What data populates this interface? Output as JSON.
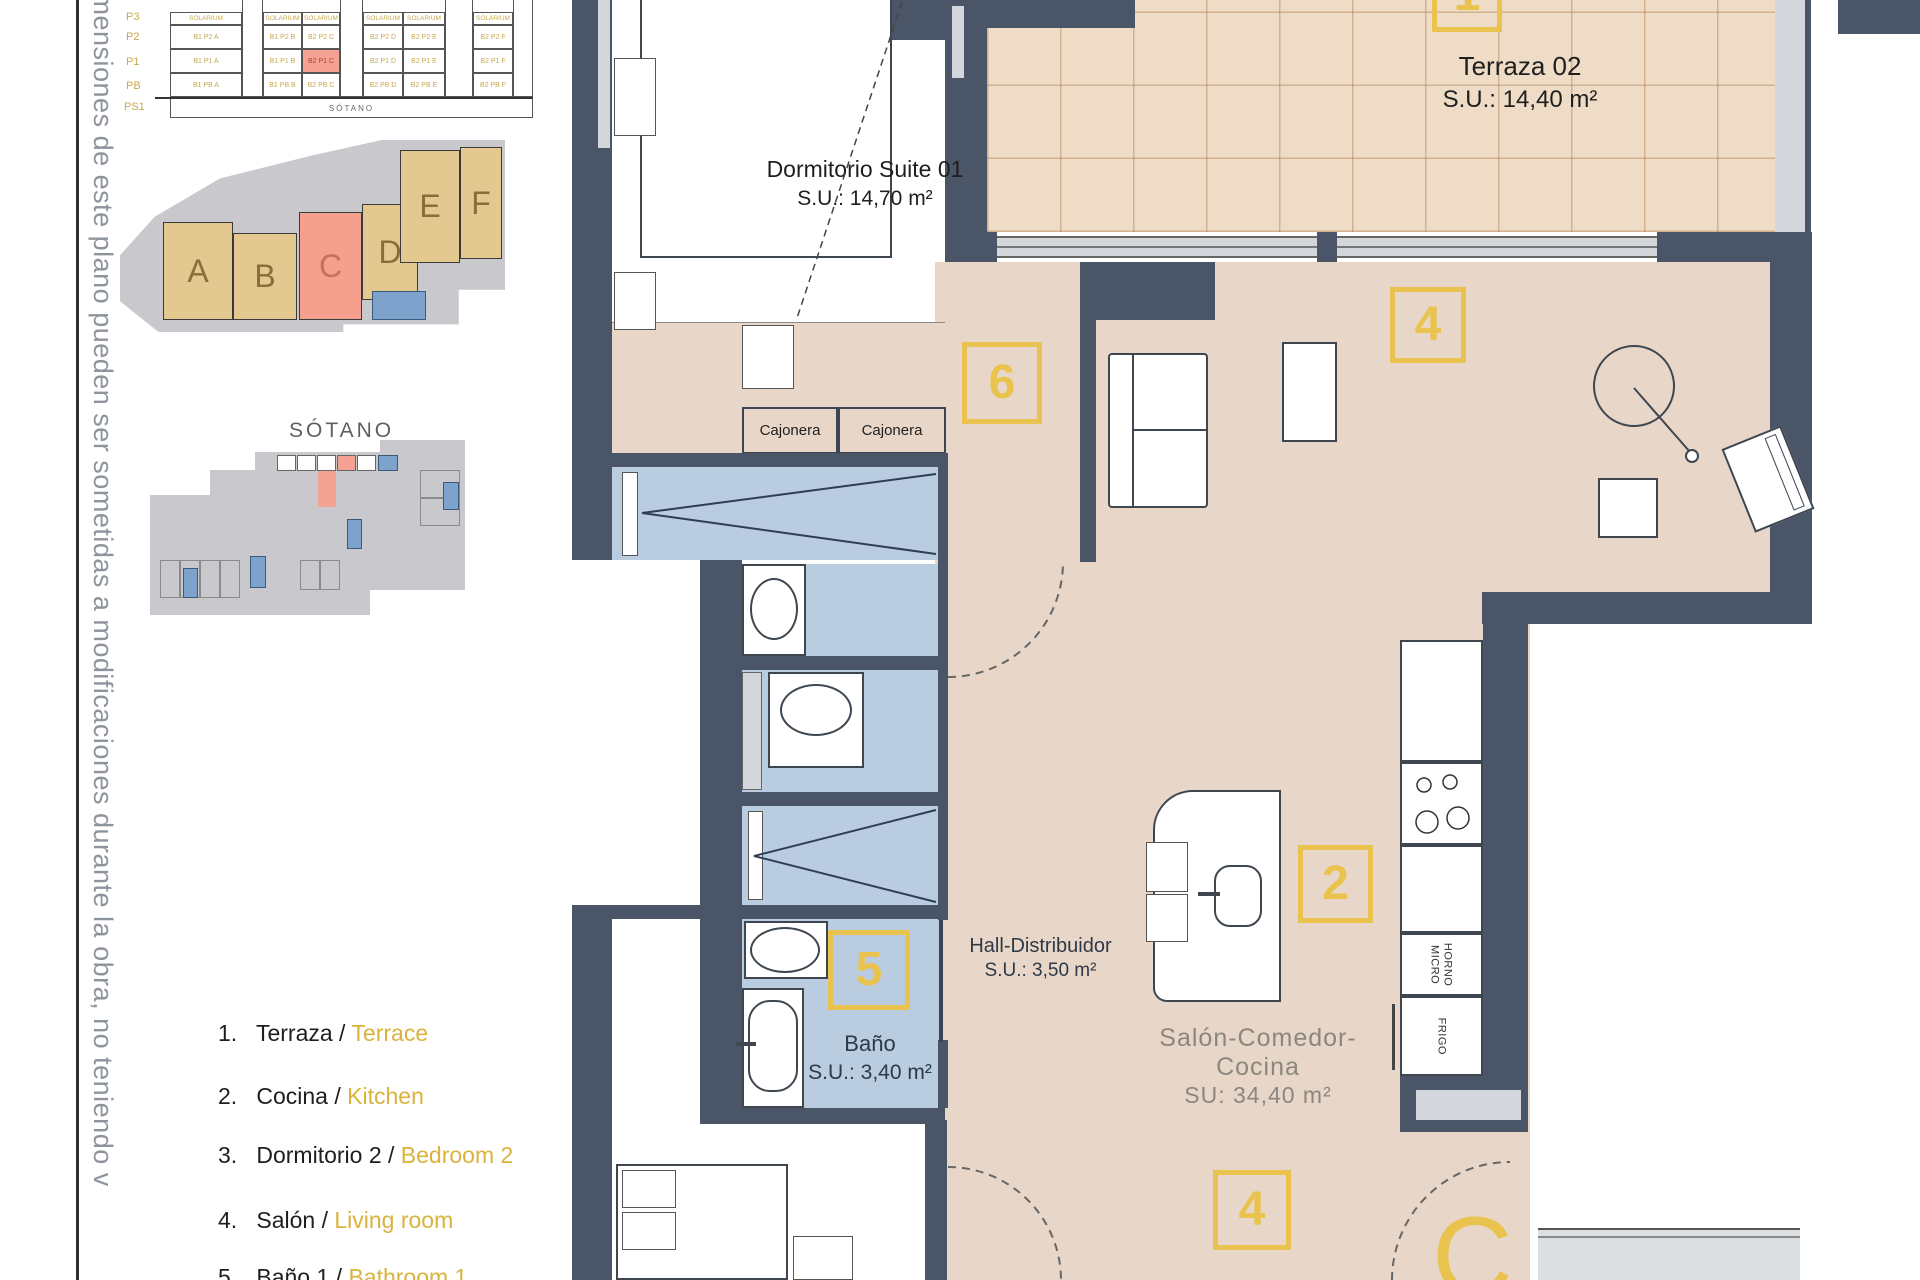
{
  "disclaimer_vertical": "imensiones de este plano pueden ser sometidas a modificaciones durante la obra, no teniendo v",
  "colors": {
    "accent_yellow": "#E9C34D",
    "highlight_salmon": "#F5A08E",
    "wall": "#4B5568",
    "floor_beige": "#E8D7C8",
    "wet_room_blue": "#B9CCE0",
    "legend_english": "#D9B33C"
  },
  "elevation_table": {
    "floor_labels": [
      "P3",
      "P2",
      "P1",
      "PB",
      "PS1"
    ],
    "header_label": "SOLARIUM",
    "rows": [
      {
        "cells": [
          "B1 P2 A",
          "B1 P2 B",
          "B2 P2 C",
          "B2 P2 D",
          "B2 P2 E",
          "B2 P2 F"
        ]
      },
      {
        "cells": [
          "B1 P1 A",
          "B1 P1 B",
          "B2 P1 C",
          "B2 P1 D",
          "B2 P1 E",
          "B2 P1 F"
        ],
        "highlighted_cell": "B2 P1 C"
      },
      {
        "cells": [
          "B1 PB A",
          "B1 PB B",
          "B2 PB C",
          "B2 PB D",
          "B2 PB E",
          "B2 PB F"
        ]
      }
    ],
    "basement_label": "SÓTANO"
  },
  "site_plan": {
    "buildings": [
      {
        "letter": "A"
      },
      {
        "letter": "B"
      },
      {
        "letter": "C"
      },
      {
        "letter": "D"
      },
      {
        "letter": "E"
      },
      {
        "letter": "F"
      }
    ],
    "highlighted_building": "C"
  },
  "basement_plan": {
    "title": "SÓTANO"
  },
  "floor_plan": {
    "rooms": {
      "suite": {
        "name": "Dormitorio Suite 01",
        "area": "S.U.: 14,70 m²"
      },
      "terraza": {
        "name": "Terraza 02",
        "area": "S.U.: 14,40 m²"
      },
      "bano": {
        "name": "Baño",
        "area": "S.U.: 3,40 m²"
      },
      "hall": {
        "name": "Hall-Distribuidor",
        "area": "S.U.: 3,50 m²"
      },
      "salon": {
        "name": "Salón-Comedor-Cocina",
        "area": "SU: 34,40 m²"
      }
    },
    "cajonera_labels": [
      "Cajonera",
      "Cajonera"
    ],
    "markers": {
      "terrace": "1",
      "kitchen": "2",
      "living_top": "4",
      "living_bottom": "4",
      "bath": "5",
      "suite": "6"
    },
    "kitchen_labels": {
      "oven": "HORNO",
      "micro": "MICRO",
      "fridge": "FRIGO"
    },
    "unit_letter": "C"
  },
  "legend": {
    "separator": "/",
    "items": [
      {
        "num": "1.",
        "es": "Terraza",
        "en": "Terrace"
      },
      {
        "num": "2.",
        "es": "Cocina",
        "en": "Kitchen"
      },
      {
        "num": "3.",
        "es": "Dormitorio 2",
        "en": "Bedroom 2"
      },
      {
        "num": "4.",
        "es": "Salón",
        "en": "Living room"
      },
      {
        "num": "5.",
        "es": "Baño 1",
        "en": "Bathroom 1"
      }
    ]
  }
}
